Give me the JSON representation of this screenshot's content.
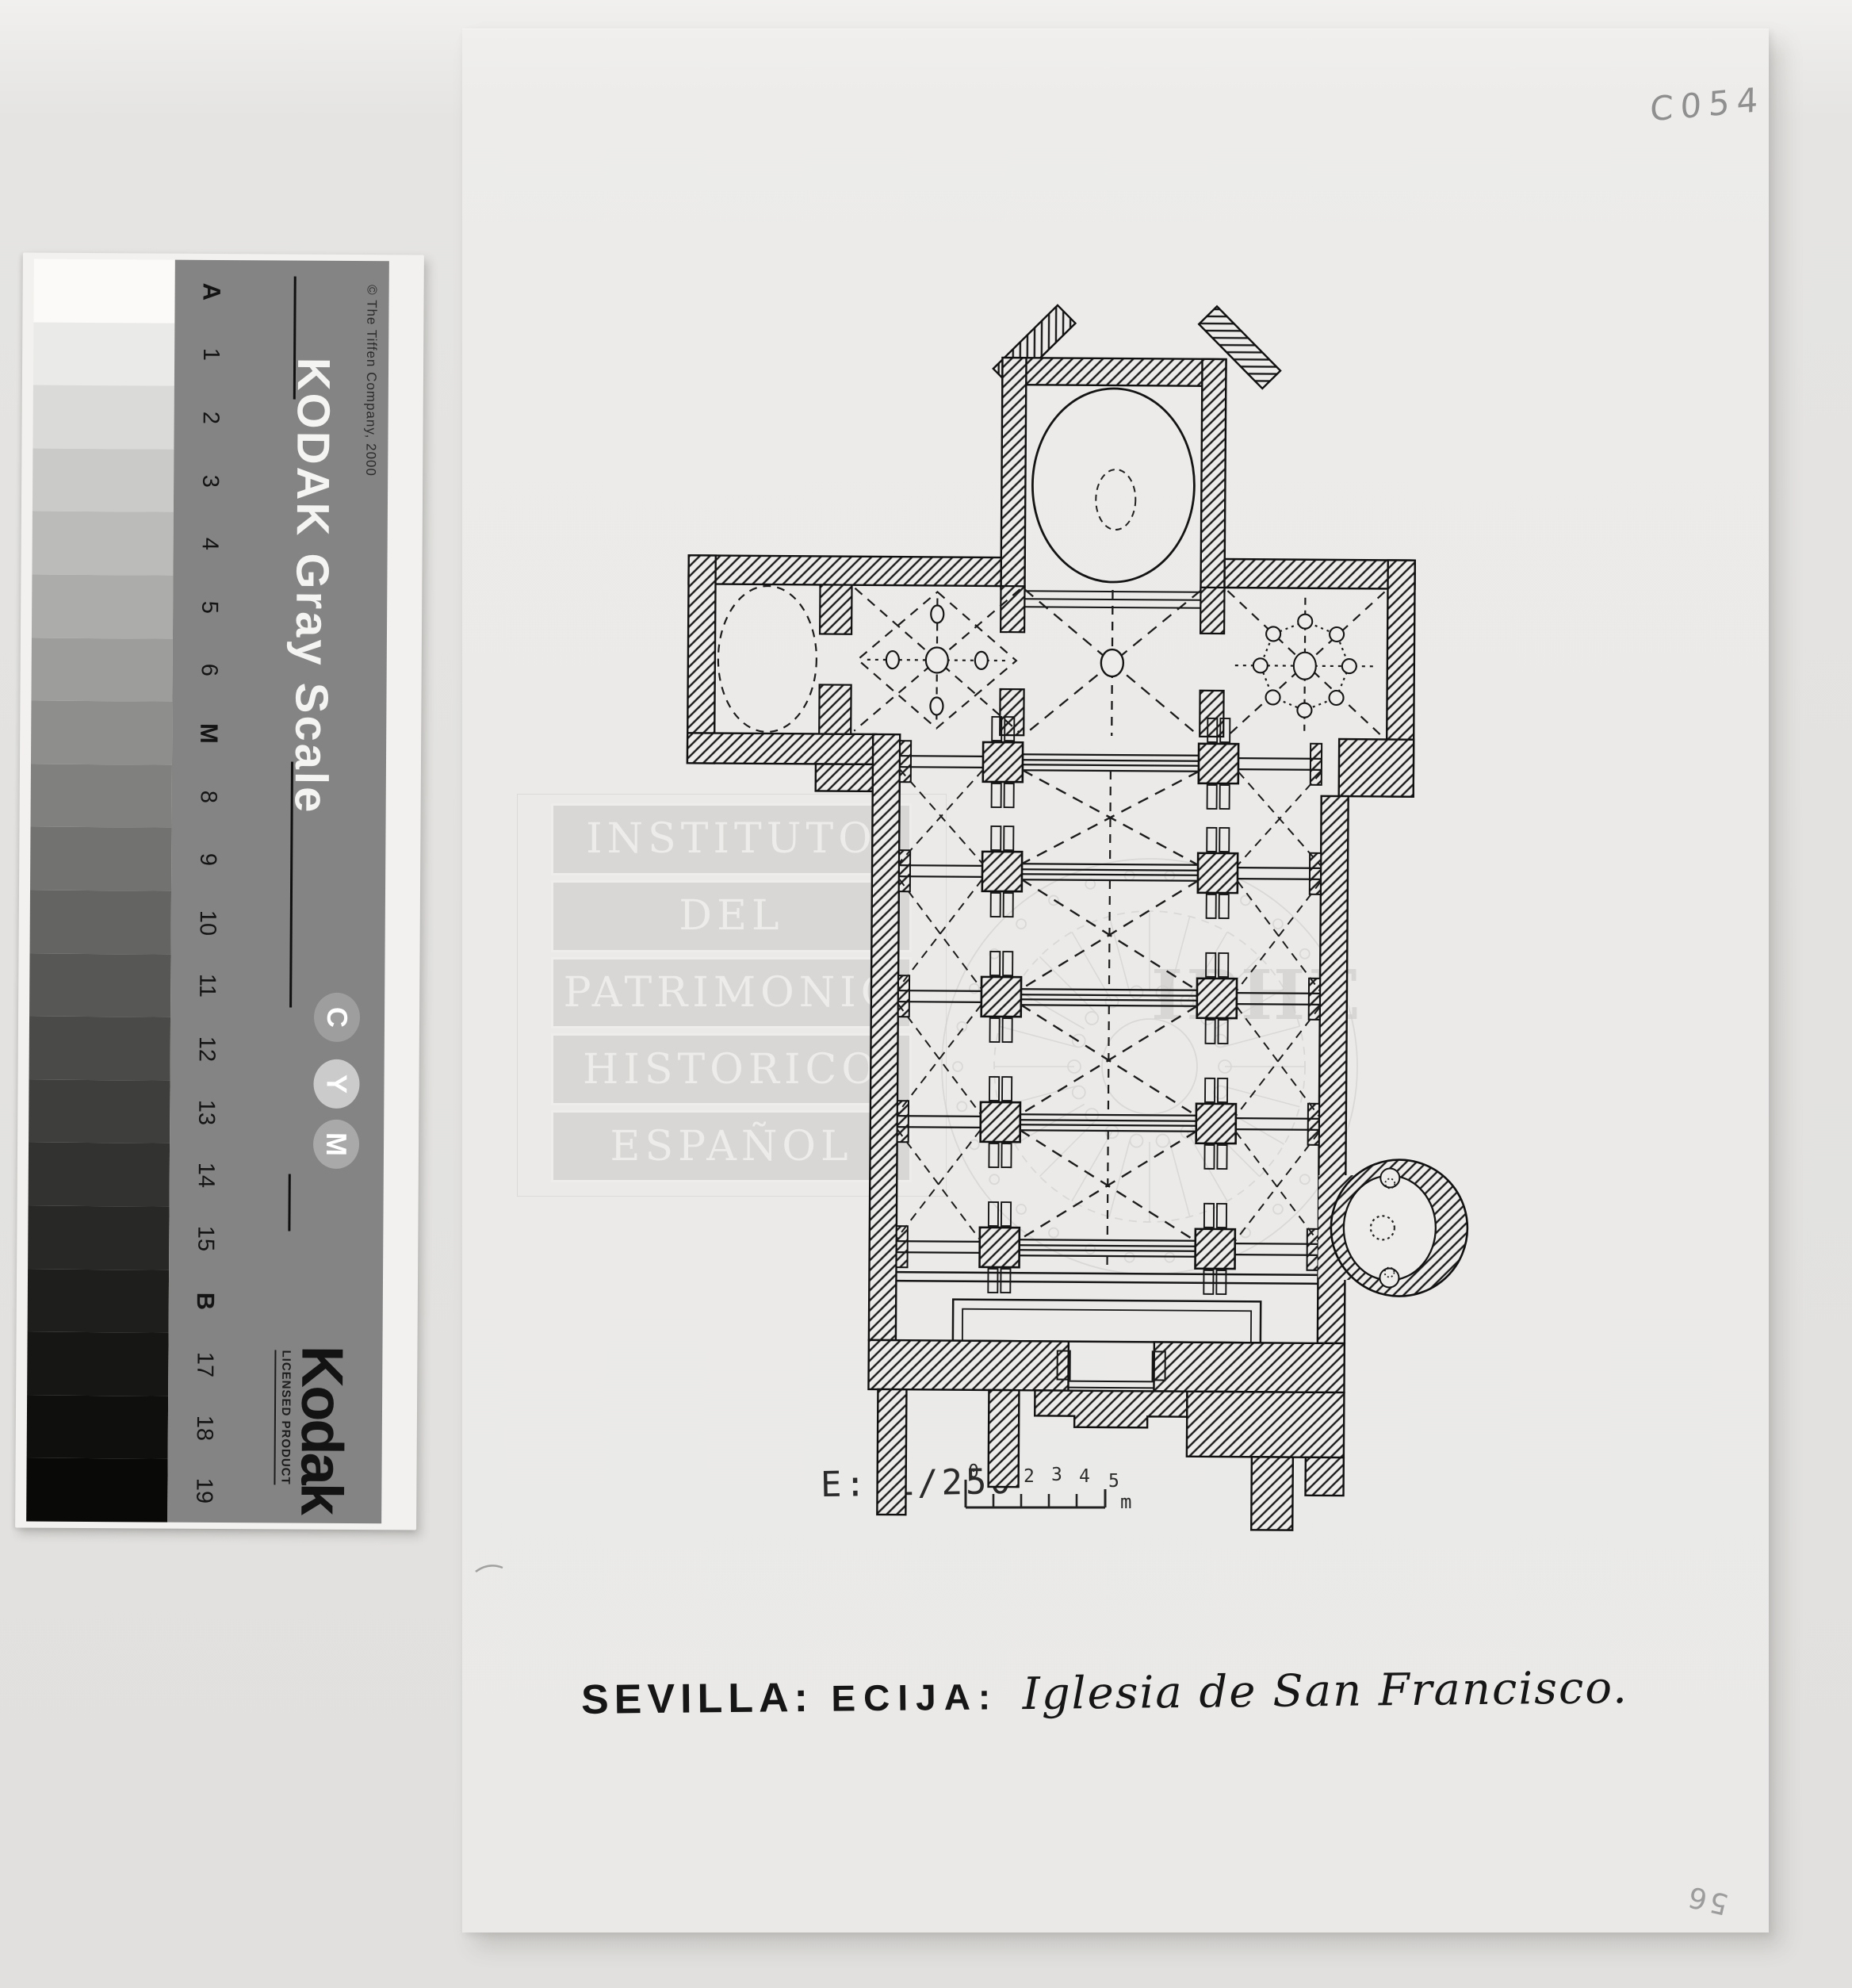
{
  "photo": {
    "archive_code": "C054",
    "reverse_number": "56"
  },
  "gray_scale": {
    "title": "KODAK Gray Scale",
    "copyright": "© The Tiffen Company, 2000",
    "step_labels": [
      "A",
      "1",
      "2",
      "3",
      "4",
      "5",
      "6",
      "M",
      "8",
      "9",
      "10",
      "11",
      "12",
      "13",
      "14",
      "15",
      "B",
      "17",
      "18",
      "19"
    ],
    "patch_colors": [
      "#fbfaf8",
      "#eaeae8",
      "#dadad8",
      "#cacac8",
      "#bbbbb9",
      "#acacaa",
      "#9d9d9b",
      "#8e8e8c",
      "#80807e",
      "#727270",
      "#646462",
      "#575755",
      "#4a4a48",
      "#3e3e3c",
      "#323230",
      "#282826",
      "#1e1e1c",
      "#161614",
      "#0f0f0d",
      "#090907"
    ],
    "badges": [
      {
        "letter": "C",
        "color": "#9e9e9e"
      },
      {
        "letter": "Y",
        "color": "#cbcbcb"
      },
      {
        "letter": "M",
        "color": "#a9a9a9"
      }
    ],
    "logo": "Kodak",
    "license_text": "LICENSED PRODUCT",
    "card_color": "#848484"
  },
  "sheet": {
    "watermark_lines": [
      "INSTITUTO",
      "DEL",
      "PATRIMONIO",
      "HISTORICO",
      "ESPAÑOL"
    ],
    "watermark_acronym": "IPHE",
    "scale_label": "E: 1/250",
    "scale_ticks": [
      "0",
      "1",
      "2",
      "3",
      "4",
      "5"
    ],
    "scale_unit": "m",
    "caption_province": "SEVILLA:",
    "caption_town": "ECIJA:",
    "caption_title": "Iglesia de San Francisco."
  }
}
